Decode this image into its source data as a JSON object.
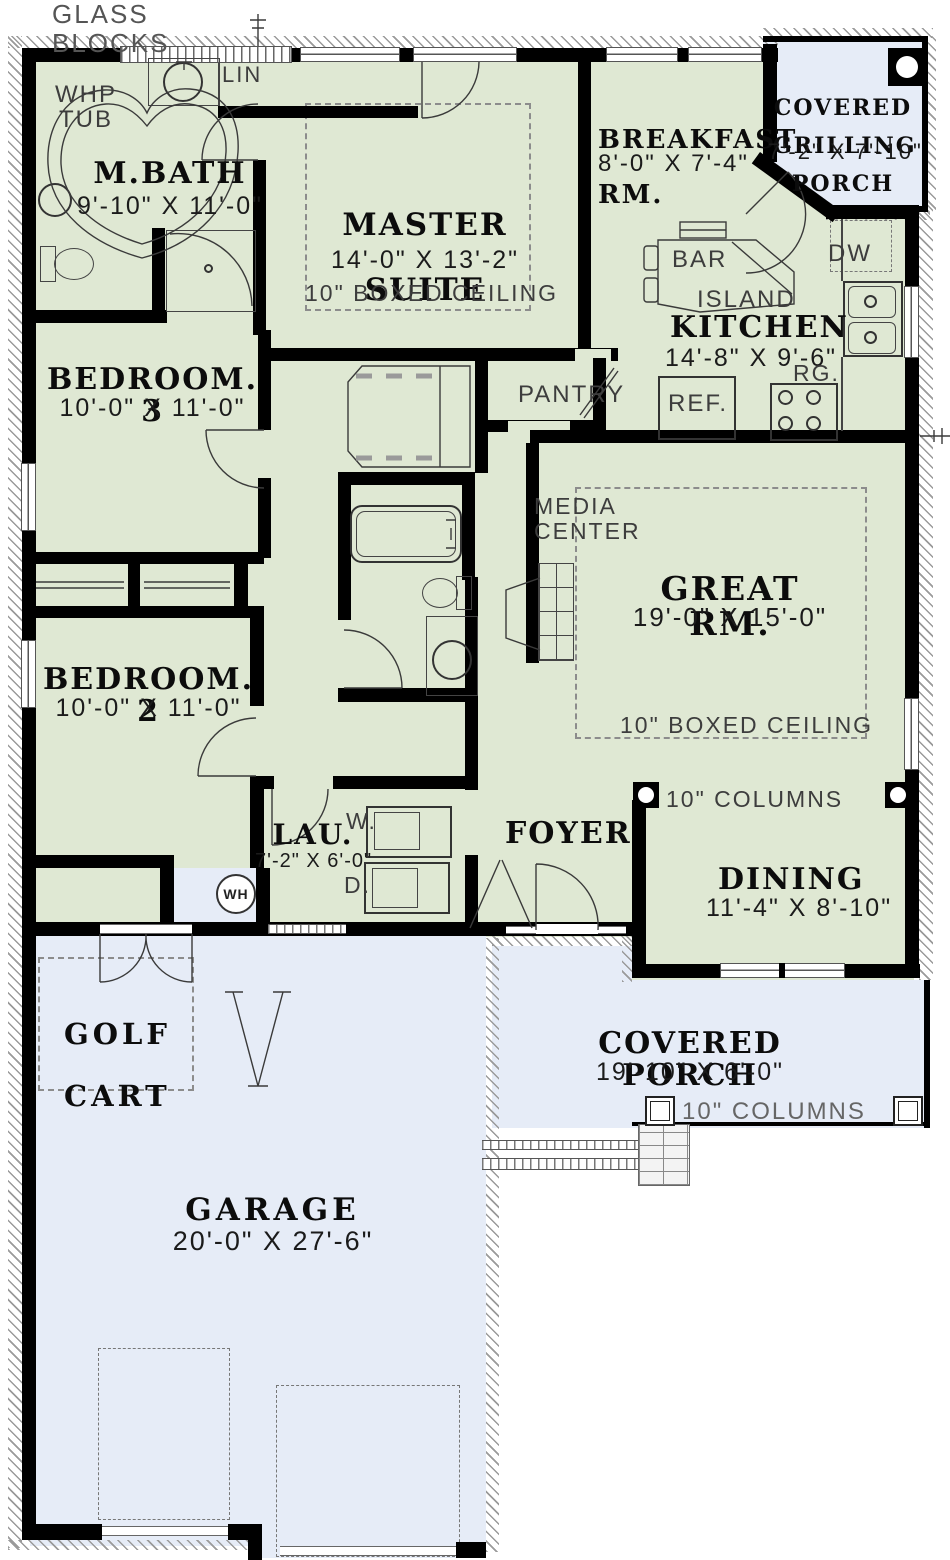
{
  "colors": {
    "interior": "#dfe8d3",
    "porch_blue": "#e6ecf7",
    "wall": "#000000",
    "linework": "#3a3a3a"
  },
  "rooms": {
    "mbath": {
      "name": "M.BATH",
      "dims": "9'-10\" X 11'-0\""
    },
    "master": {
      "name1": "MASTER",
      "name2": "SUITE",
      "dims": "14'-0\" X 13'-2\"",
      "ceiling": "10\" BOXED CEILING"
    },
    "breakfast": {
      "name1": "BREAKFAST",
      "name2": "RM.",
      "dims": "8'-0\" X 7'-4\""
    },
    "grilling": {
      "name1": "COVERED",
      "name2": "GRILLING",
      "name3": "PORCH",
      "dims": "7'-2\" X 7'-10\""
    },
    "kitchen": {
      "name": "KITCHEN",
      "dims": "14'-8\" X 9'-6\""
    },
    "bedroom3": {
      "name": "BEDROOM. 3",
      "dims": "10'-0\" X 11'-0\""
    },
    "greatrm": {
      "name": "GREAT RM.",
      "dims": "19'-0\" X 15'-0\"",
      "ceiling": "10\" BOXED CEILING"
    },
    "bedroom2": {
      "name": "BEDROOM. 2",
      "dims": "10'-0\" X 11'-0\""
    },
    "laundry": {
      "name": "LAU.",
      "dims": "7'-2\" X 6'-0\""
    },
    "foyer": {
      "name": "FOYER"
    },
    "dining": {
      "name": "DINING",
      "dims": "11'-4\" X 8'-10\""
    },
    "golfcart": {
      "name1": "GOLF",
      "name2": "CART"
    },
    "porch": {
      "name": "COVERED PORCH",
      "dims": "19'-10\" X 6'-0\""
    },
    "garage": {
      "name": "GARAGE",
      "dims": "20'-0\" X 27'-6\""
    }
  },
  "fixtures": {
    "whp1": "WHP",
    "whp2": "TUB",
    "lin": "LIN",
    "pantry": "PANTRY",
    "media1": "MEDIA",
    "media2": "CENTER",
    "bar": "BAR",
    "island": "ISLAND",
    "dw": "DW",
    "ref": "REF.",
    "rg": "RG.",
    "washer": "W.",
    "dryer": "D.",
    "wh": "WH"
  },
  "annotations": {
    "glass1": "GLASS",
    "glass2": "BLOCKS",
    "columns": "10\" COLUMNS"
  }
}
